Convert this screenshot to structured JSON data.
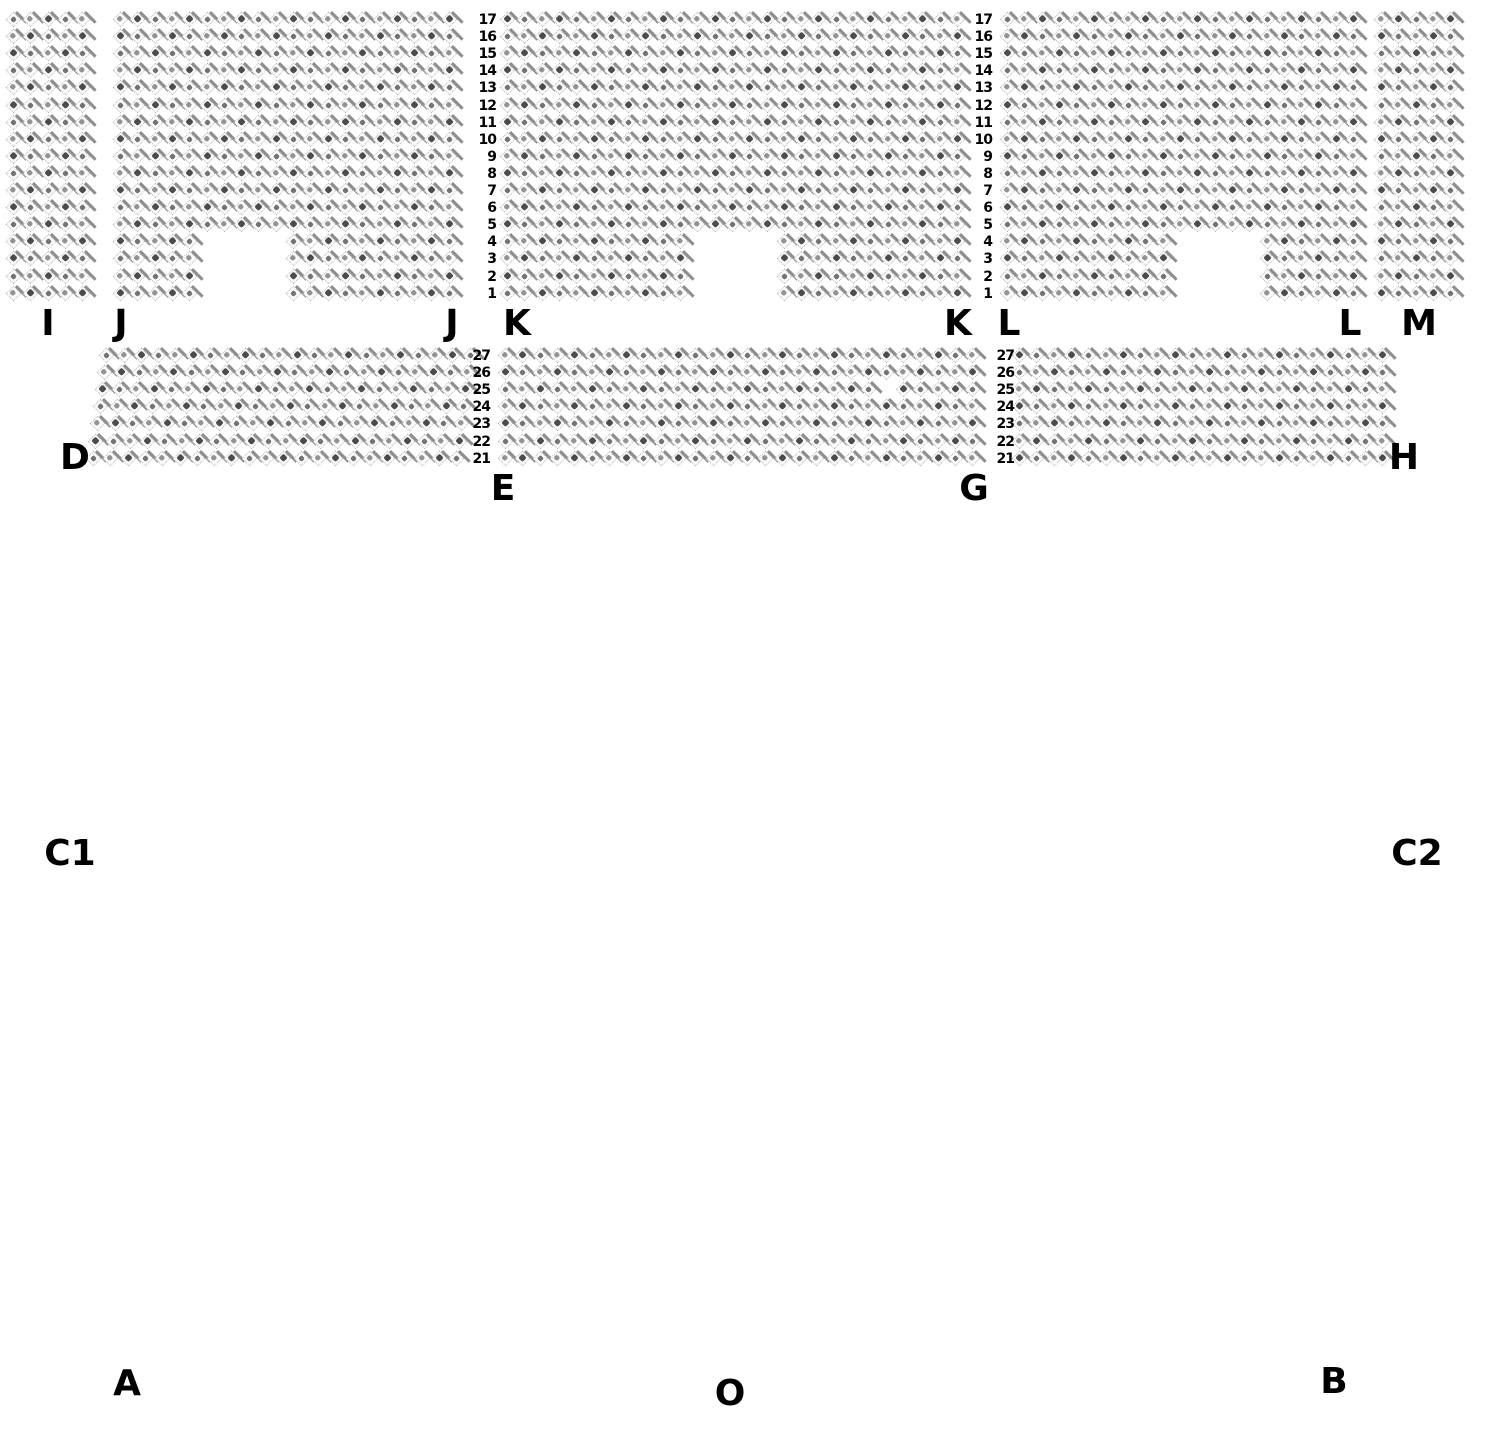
{
  "venue_map": {
    "background_color": "#ffffff",
    "seat_border_color": "#b3b3b3",
    "seat_shadow_color": "#8d8d8d",
    "seat_fill_color": "#3d3d3d",
    "label_color": "#000000",
    "upper_band": {
      "top": 14,
      "label_y": 306,
      "rows_top_to_bottom": [
        17,
        16,
        15,
        14,
        13,
        12,
        11,
        10,
        9,
        8,
        7,
        6,
        5,
        4,
        3,
        2,
        1
      ],
      "row_number_columns_x": [
        470,
        966
      ],
      "sections": [
        {
          "name": "I",
          "left": 8,
          "cols": 5,
          "labels": [
            {
              "text": "I",
              "x": 48
            }
          ]
        },
        {
          "name": "J",
          "left": 115,
          "cols": 20,
          "notch": {
            "rows": [
              1,
              2,
              3,
              4
            ],
            "first_col": 6,
            "last_col": 10
          },
          "labels": [
            {
              "text": "J",
              "x": 121
            },
            {
              "text": "J",
              "x": 452
            }
          ]
        },
        {
          "name": "K",
          "left": 502,
          "cols": 27,
          "notch": {
            "rows": [
              1,
              2,
              3,
              4
            ],
            "first_col": 12,
            "last_col": 16
          },
          "labels": [
            {
              "text": "K",
              "x": 517
            },
            {
              "text": "K",
              "x": 958
            }
          ]
        },
        {
          "name": "L",
          "left": 1002,
          "cols": 21,
          "notch": {
            "rows": [
              1,
              2,
              3,
              4
            ],
            "first_col": 11,
            "last_col": 15
          },
          "labels": [
            {
              "text": "L",
              "x": 1009
            },
            {
              "text": "L",
              "x": 1350
            }
          ]
        },
        {
          "name": "M",
          "left": 1376,
          "cols": 5,
          "labels": [
            {
              "text": "M",
              "x": 1419
            }
          ]
        }
      ]
    },
    "lower_band": {
      "top": 350,
      "rows_top_to_bottom": [
        27,
        26,
        25,
        24,
        23,
        22,
        21
      ],
      "row_number_columns_x": [
        464,
        988
      ],
      "sections": [
        {
          "name": "D",
          "left": 88,
          "cols": 22,
          "slant": 2.2,
          "labels": [
            {
              "text": "D",
              "x": 75,
              "y": 440
            }
          ]
        },
        {
          "name": "E",
          "left": 500,
          "cols": 28,
          "missing": [
            {
              "row": 25,
              "col": 23
            }
          ],
          "labels": [
            {
              "text": "E",
              "x": 503,
              "y": 471
            }
          ]
        },
        {
          "name": "GH",
          "left": 1014,
          "cols": 22,
          "labels": [
            {
              "text": "G",
              "x": 974,
              "y": 471
            },
            {
              "text": "H",
              "x": 1404,
              "y": 440
            }
          ]
        }
      ]
    },
    "floor_labels": [
      {
        "text": "C1",
        "x": 70,
        "y": 836
      },
      {
        "text": "C2",
        "x": 1417,
        "y": 836
      },
      {
        "text": "A",
        "x": 127,
        "y": 1366
      },
      {
        "text": "O",
        "x": 730,
        "y": 1376
      },
      {
        "text": "B",
        "x": 1334,
        "y": 1364
      }
    ]
  }
}
